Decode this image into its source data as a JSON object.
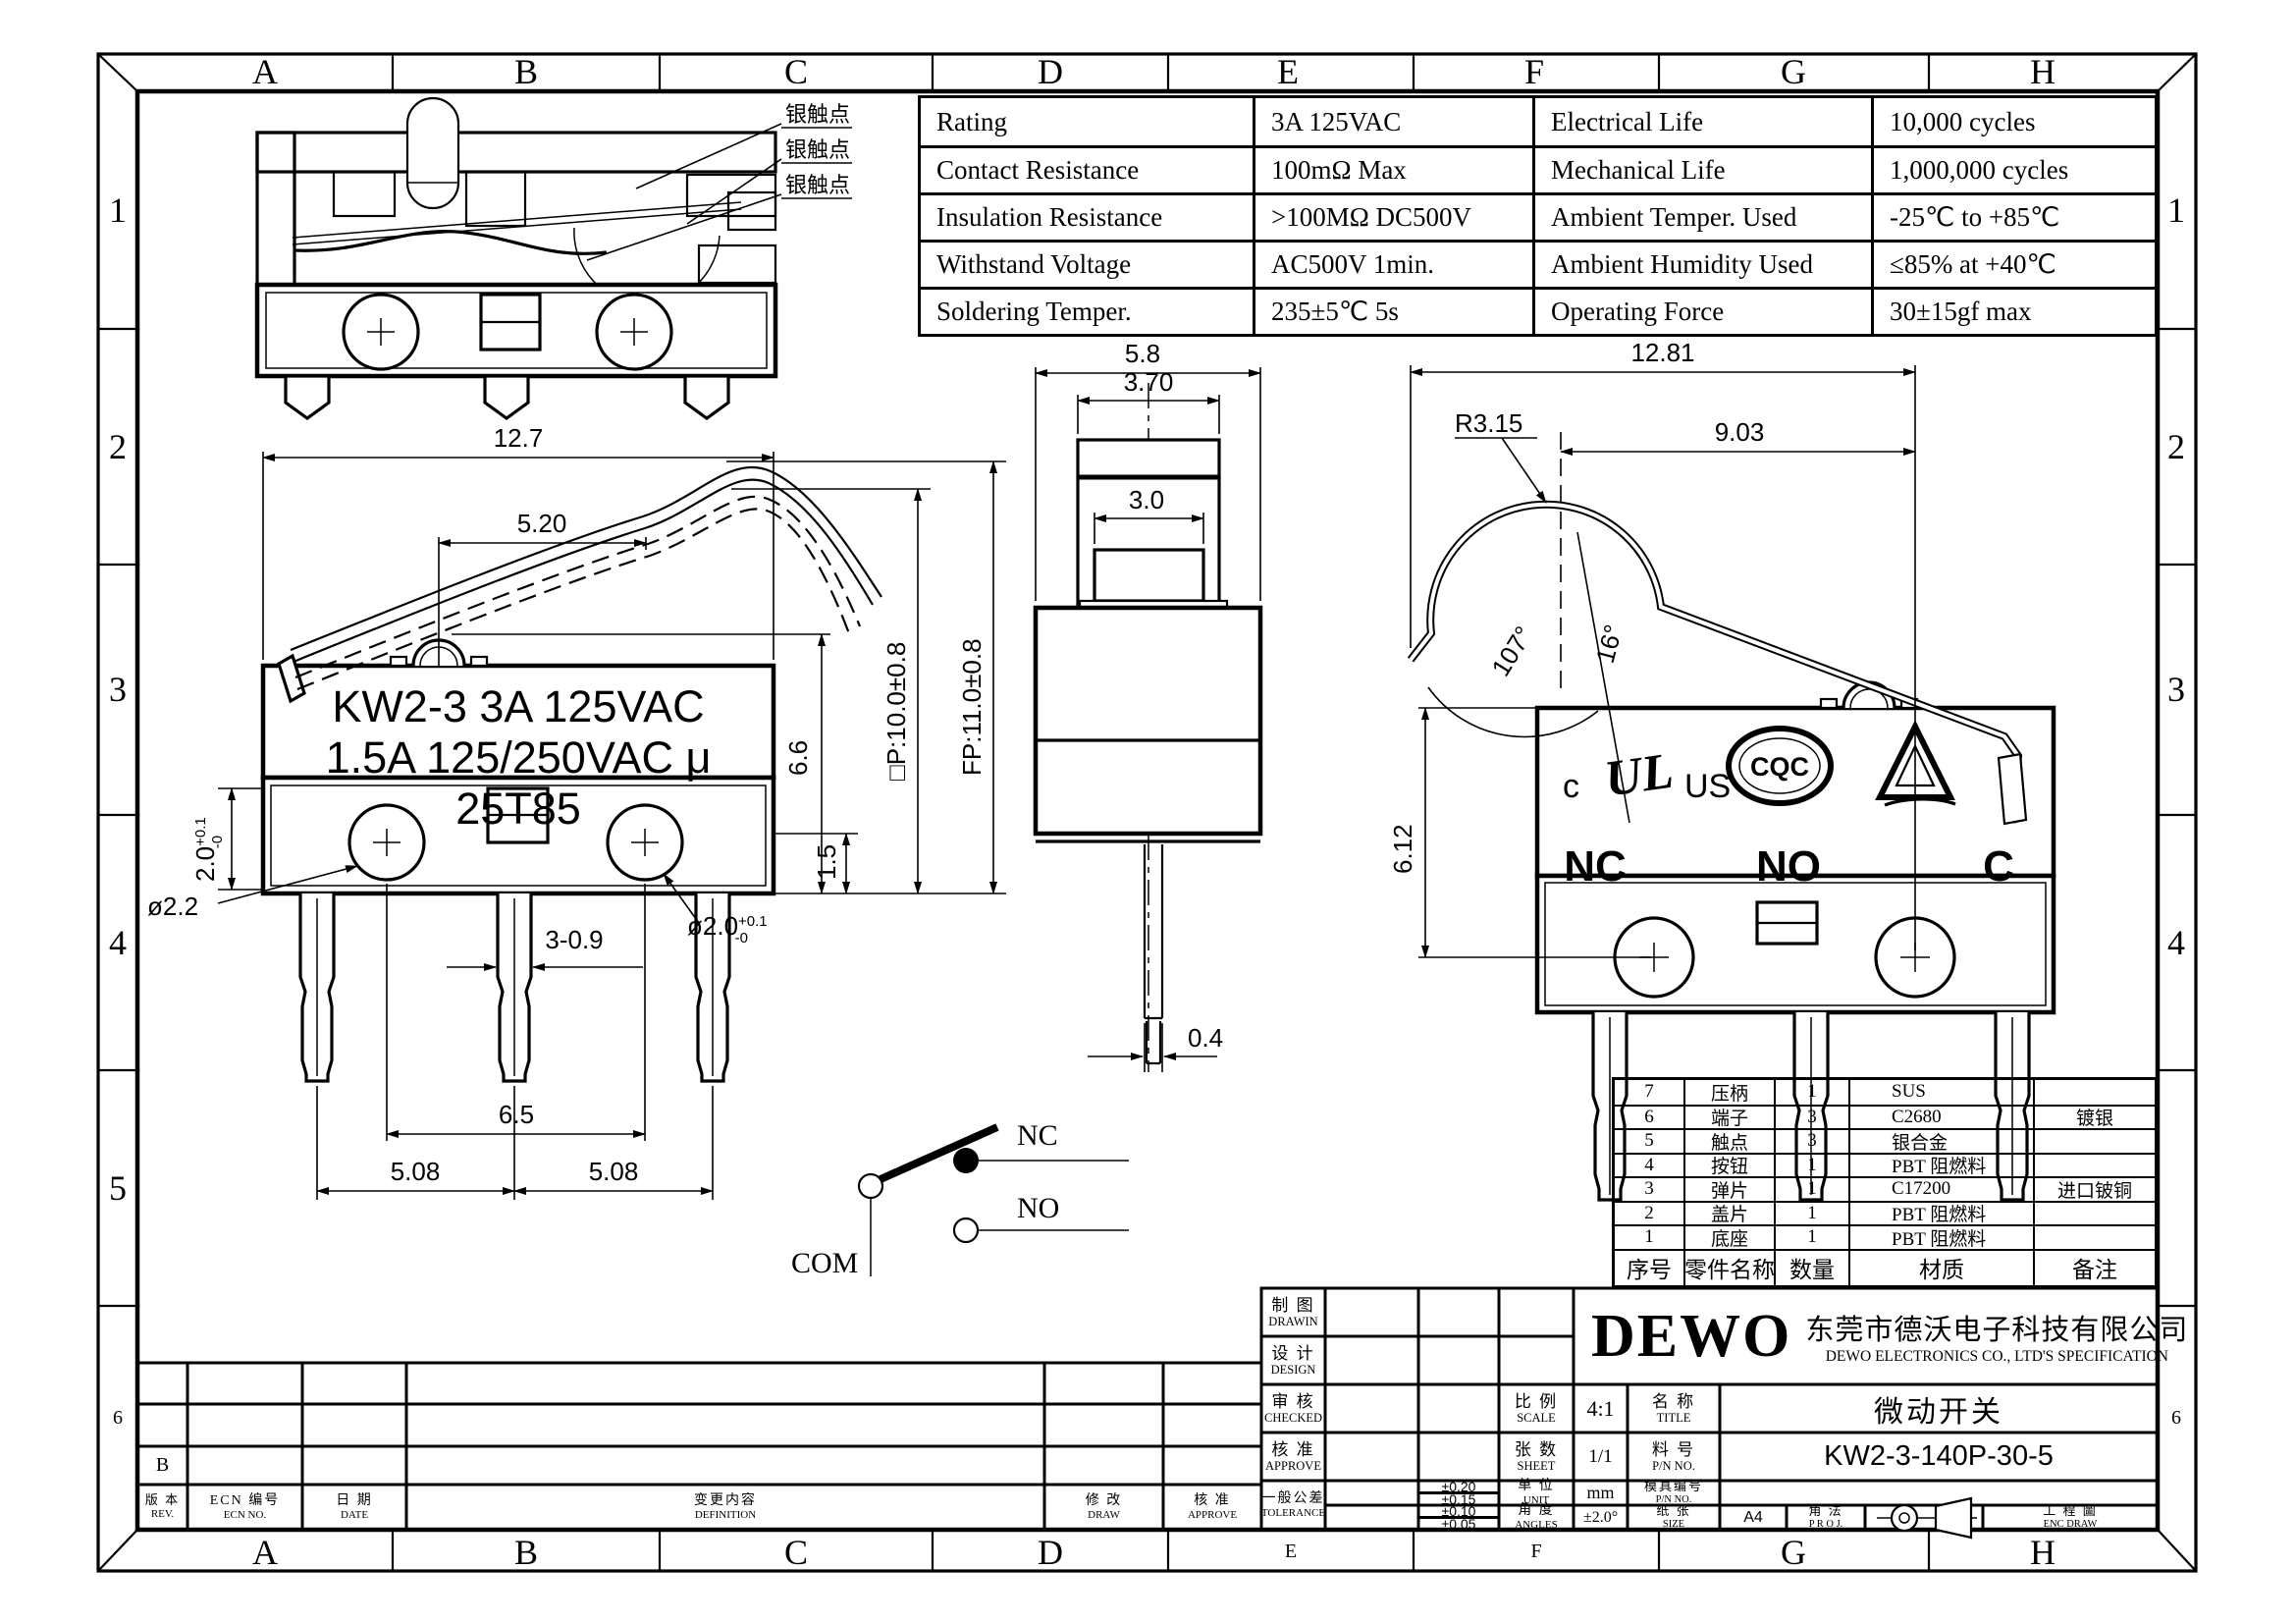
{
  "border": {
    "cols": [
      "A",
      "B",
      "C",
      "D",
      "E",
      "F",
      "G",
      "H"
    ],
    "rows_left": [
      "1",
      "2",
      "3",
      "4",
      "5",
      "6"
    ],
    "rows_right": [
      "1",
      "2",
      "3",
      "4",
      "6"
    ]
  },
  "spec_table": {
    "rows": [
      {
        "p1": "Rating",
        "v1": "3A  125VAC",
        "p2": "Electrical Life",
        "v2": "10,000 cycles"
      },
      {
        "p1": "Contact Resistance",
        "v1": "100mΩ Max",
        "p2": "Mechanical Life",
        "v2": "1,000,000 cycles"
      },
      {
        "p1": "Insulation Resistance",
        "v1": ">100MΩ DC500V",
        "p2": "Ambient Temper. Used",
        "v2": "-25℃ to +85℃"
      },
      {
        "p1": "Withstand Voltage",
        "v1": "AC500V  1min.",
        "p2": "Ambient Humidity Used",
        "v2": "≤85% at +40℃"
      },
      {
        "p1": "Soldering Temper.",
        "v1": "235±5℃ 5s",
        "p2": "Operating Force",
        "v2": "30±15gf max"
      }
    ]
  },
  "section_view": {
    "labels": [
      "银触点",
      "银触点",
      "银触点"
    ]
  },
  "front_view": {
    "marking": {
      "l1": "KW2-3 3A 125VAC",
      "l2": "1.5A 125/250VAC μ",
      "l3": "25T85"
    },
    "dims": {
      "width": "12.7",
      "lever": "5.20",
      "height": "6.6",
      "base_step": "1.5",
      "base_h": "2.0",
      "base_h_tol_u": "+0.1",
      "base_h_tol_d": "-0",
      "rivet_d": "ø2.2",
      "term_w": "3-0.9",
      "hole_d": "ø2.0",
      "hole_tol_u": "+0.1",
      "hole_tol_d": "-0",
      "rivet_span": "6.5",
      "pitch_l": "5.08",
      "pitch_r": "5.08",
      "op_pos": "□P:10.0±0.8",
      "fp_pos": "FP:11.0±0.8"
    }
  },
  "side_view": {
    "dims": {
      "width": "5.8",
      "button_w": "3.70",
      "plunger_w": "3.0",
      "term_t": "0.4"
    }
  },
  "right_view": {
    "dims": {
      "total_w": "12.81",
      "lever_l": "9.03",
      "lever_r": "R3.15",
      "angle_lever": "107°",
      "angle_free": "16°",
      "height": "6.12"
    },
    "cert": {
      "ul_c": "c",
      "ul": "UL",
      "ul_us": "US",
      "cqc": "CQC"
    },
    "terminals": {
      "nc": "NC",
      "no": "NO",
      "c": "C"
    }
  },
  "circuit": {
    "nc": "NC",
    "no": "NO",
    "com": "COM"
  },
  "parts_table": {
    "headers": [
      "序号",
      "零件名称",
      "数量",
      "材质",
      "备注"
    ],
    "rows": [
      [
        "7",
        "压柄",
        "1",
        "SUS",
        ""
      ],
      [
        "6",
        "端子",
        "3",
        "C2680",
        "镀银"
      ],
      [
        "5",
        "触点",
        "3",
        "银合金",
        ""
      ],
      [
        "4",
        "按钮",
        "1",
        "PBT 阻燃料",
        ""
      ],
      [
        "3",
        "弹片",
        "1",
        "C17200",
        "进口铍铜"
      ],
      [
        "2",
        "盖片",
        "1",
        "PBT 阻燃料",
        ""
      ],
      [
        "1",
        "底座",
        "1",
        "PBT 阻燃料",
        ""
      ]
    ]
  },
  "title_block": {
    "logo": "DEWO",
    "company_cn": "东莞市德沃电子科技有限公司",
    "company_en": "DEWO ELECTRONICS CO., LTD'S SPECIFICATION",
    "drawin": {
      "cn": "制 图",
      "en": "DRAWIN"
    },
    "design": {
      "cn": "设 计",
      "en": "DESIGN"
    },
    "checked": {
      "cn": "审 核",
      "en": "CHECKED"
    },
    "approve": {
      "cn": "核 准",
      "en": "APPROVE"
    },
    "tolerance": {
      "cn": "一般公差",
      "en": "TOLERANCE",
      "v1": "±0.20",
      "v2": "±0.15",
      "v3": "±0.10",
      "v4": "±0.05"
    },
    "scale": {
      "cn": "比 例",
      "en": "SCALE",
      "val": "4:1"
    },
    "sheet": {
      "cn": "张 数",
      "en": "SHEET",
      "val": "1/1"
    },
    "unit": {
      "cn": "单 位",
      "en": "UNIT",
      "val": "mm"
    },
    "angles": {
      "cn": "角 度",
      "en": "ANGLES",
      "val": "±2.0°"
    },
    "title": {
      "cn": "名 称",
      "en": "TITLE",
      "val": "微动开关"
    },
    "pn": {
      "cn": "料 号",
      "en": "P/N NO.",
      "val": "KW2-3-140P-30-5"
    },
    "mold": {
      "cn": "模具编号",
      "en": "P/N NO."
    },
    "size": {
      "cn": "纸 张",
      "en": "SIZE",
      "val": "A4"
    },
    "proj": {
      "cn": "角 法",
      "en": "P R O J."
    },
    "eng": {
      "cn": "工 程 圖",
      "en": "ENC DRAW"
    }
  },
  "revision_table": {
    "rev": {
      "cn": "版 本",
      "en": "REV."
    },
    "ecn": {
      "cn": "ECN 编号",
      "en": "ECN NO."
    },
    "date": {
      "cn": "日 期",
      "en": "DATE"
    },
    "definition": {
      "cn": "变更内容",
      "en": "DEFINITION"
    },
    "draw": {
      "cn": "修 改",
      "en": "DRAW"
    },
    "approve": {
      "cn": "核 准",
      "en": "APPROVE"
    },
    "row_b": "B"
  }
}
